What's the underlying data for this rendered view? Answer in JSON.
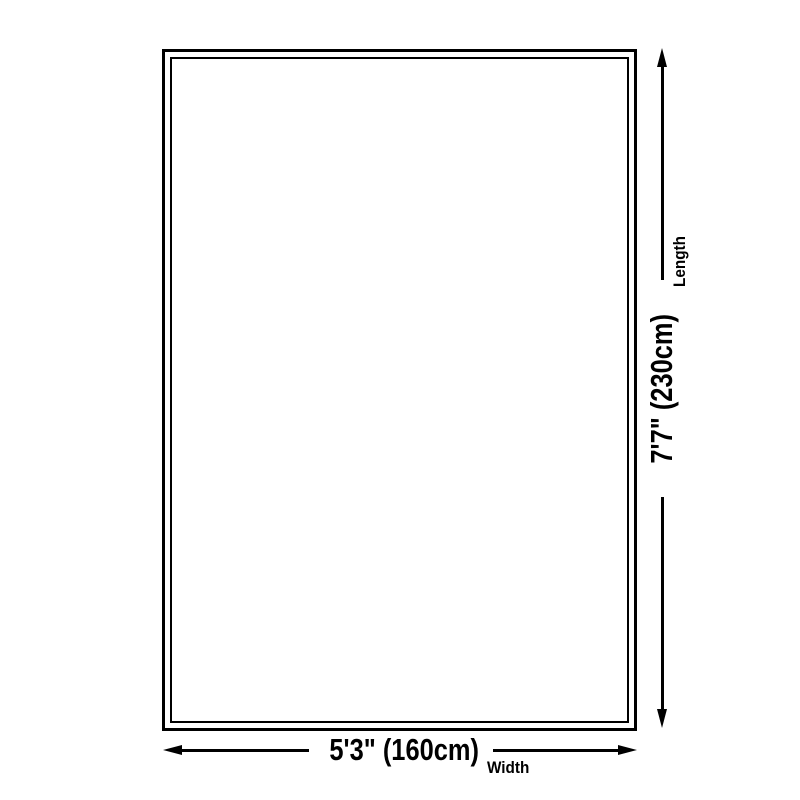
{
  "diagram": {
    "type": "product-size-diagram",
    "background_color": "#ffffff",
    "line_color": "#000000",
    "shape": "rectangle-double-border",
    "length_dimension": {
      "value": "7'7\" (230cm)",
      "label": "Length",
      "orientation": "vertical",
      "arrow_icons": [
        "arrowhead-up-icon",
        "arrowhead-down-icon"
      ]
    },
    "width_dimension": {
      "value": "5'3\" (160cm)",
      "label": "Width",
      "orientation": "horizontal",
      "arrow_icons": [
        "arrowhead-left-icon",
        "arrowhead-right-icon"
      ]
    }
  }
}
